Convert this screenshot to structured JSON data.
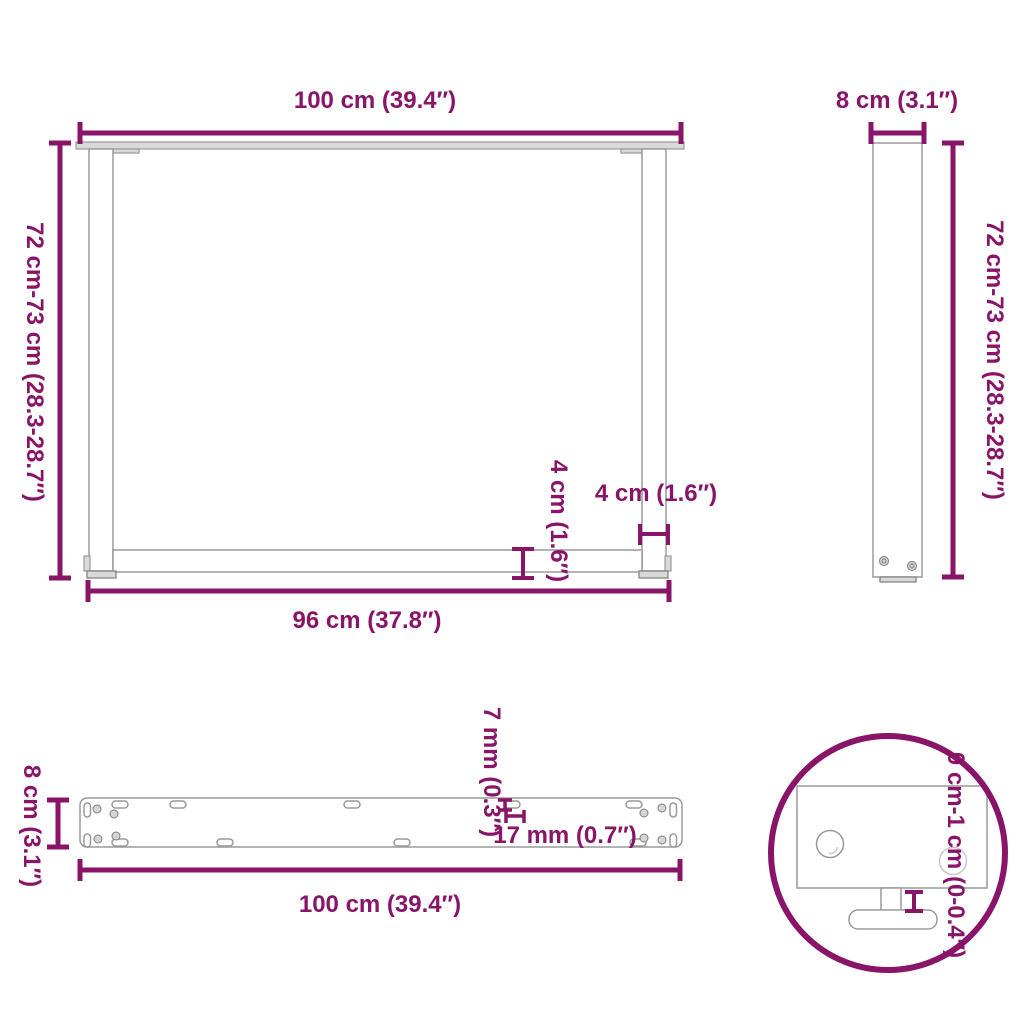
{
  "colors": {
    "dimension": "#881568",
    "product_outline": "#9A9A9A",
    "product_dark": "#7E7E7E"
  },
  "views": {
    "front": {
      "width_top": "100 cm (39.4″)",
      "height": "72 cm-73 cm (28.3-28.7″)",
      "crossbar_height": "4 cm (1.6″)",
      "leg_width": "4 cm (1.6″)",
      "width_bottom": "96 cm (37.8″)"
    },
    "side": {
      "width": "8 cm (3.1″)",
      "height": "72 cm-73 cm (28.3-28.7″)"
    },
    "top": {
      "depth": "8 cm (3.1″)",
      "slot_width": "7 mm (0.3″)",
      "slot_length": "17 mm (0.7″)",
      "length": "100 cm (39.4″)"
    },
    "detail": {
      "height_adjustment": "0 cm-1 cm (0-0.4″)"
    }
  }
}
